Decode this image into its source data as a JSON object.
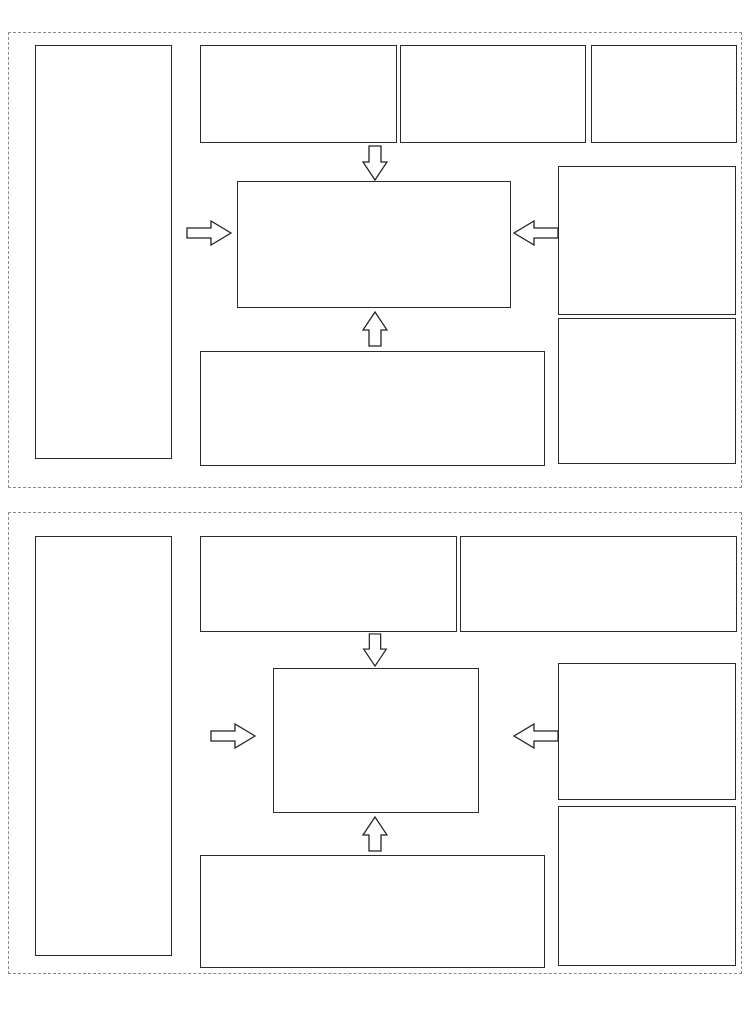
{
  "watermark": "0510-82309771",
  "footer": {
    "note": "注：以上接线均为参考配线，如有改动恕不另行通知，请以仪表随机接线图准。",
    "brand": "CCLair 昌林自动化"
  },
  "colors": {
    "watermark_red": "#ee6a5f",
    "line": "#222222",
    "cap_gray": "#a8a8a8"
  },
  "section1": {
    "title": "◆ 160 × 80mm 、 80 × 160mm 仪表端子接线图",
    "pv_box": {
      "title": "PV控制输入信号接线图",
      "groups": [
        {
          "label": "mV/TC热电偶",
          "symbol": "tc",
          "marks": [
            "+",
            "-"
          ],
          "terminals": [
            "1",
            "2"
          ]
        },
        {
          "label": "V电压",
          "symbol": "stub2",
          "marks": [
            "-",
            "+"
          ],
          "terminals": [
            "1",
            "2"
          ]
        },
        {
          "label": "mA电流",
          "symbol": "stub1brk2",
          "marks": [
            "-",
            "+"
          ],
          "terminals": [
            "1",
            "2",
            "3"
          ]
        },
        {
          "label": "RTD热电阻",
          "symbol": "res3",
          "marks": [],
          "terminals": [
            "1",
            "2",
            "4"
          ]
        },
        {
          "label": "远传压力电阻",
          "symbol": "pot3",
          "marks": [],
          "terminals": [
            "1",
            "2",
            "4"
          ]
        }
      ]
    },
    "sv_box": {
      "title": "SV阀位/外给定输入接线图",
      "groups": [
        {
          "label": "mA电流",
          "symbol": "stub1brk2",
          "marks": [
            "+",
            "-"
          ],
          "terminals": [
            "5",
            "6",
            "7"
          ]
        },
        {
          "label": "V电压",
          "symbol": "stub2",
          "marks": [
            "+",
            "-"
          ],
          "terminals": [
            "5",
            "6"
          ]
        }
      ]
    },
    "alarm_box": {
      "title": "报警输出接线图",
      "alarms": [
        {
          "header": "第一报警",
          "name": "AL1",
          "sw": "ON",
          "terminals": [
            "14",
            "15"
          ]
        },
        {
          "header": "第二报警",
          "name": "AL2",
          "sw": "ON",
          "terminals": [
            "16",
            "17"
          ]
        }
      ]
    },
    "rs485_box": {
      "title": "RS485通讯接口",
      "rows": [
        {
          "label": "T/R (B)",
          "terminal": "11"
        },
        {
          "label": "T/R (A)",
          "terminal": "12"
        }
      ]
    },
    "center_box": {
      "top_row": [
        "1",
        "2",
        "3",
        "4",
        "5",
        "6",
        "7",
        "8",
        "9",
        "10",
        "11",
        "12"
      ],
      "dims": [
        "外形：160×80×100mm",
        "外形：80×160×100mm"
      ],
      "bottom_row": [
        "13",
        "14",
        "15",
        "16",
        "17",
        "18",
        "19",
        "20",
        "21",
        "22",
        "23",
        "24"
      ]
    },
    "power_box": {
      "title": "电源接线图",
      "ac": {
        "terminals": [
          "22",
          "23",
          "24"
        ],
        "ground": "地",
        "label": "AC90~265V",
        "signs": [
          "",
          ""
        ]
      },
      "dc": {
        "terminals": [
          "23",
          "24"
        ],
        "label": "DC24V",
        "signs": [
          "+",
          "-"
        ]
      }
    },
    "output_box": {
      "title": "输出接线图",
      "groups": [
        {
          "label": "调节输出",
          "terminals": [
            "9",
            "10"
          ],
          "sig": "mA/V",
          "signs": [
            "-",
            "+"
          ]
        },
        {
          "label": "变送输出",
          "terminals": [
            "11",
            "12"
          ],
          "sig": "mA/V",
          "signs": [
            "-",
            "+"
          ]
        },
        {
          "label": "馈电输出",
          "terminals": [
            "1",
            "13"
          ],
          "sig": "DC24V",
          "signs": [
            "-",
            "+"
          ]
        }
      ]
    },
    "valve_box": {
      "title": "阀位控制输出接线图",
      "relay": {
        "caption": "继电器控制输出接线图",
        "groups": [
          {
            "label": "正转",
            "sw": "ON",
            "terminals": [
              "20",
              "21"
            ]
          },
          {
            "label": "反转",
            "sw": "ON",
            "terminals": [
              "18",
              "19"
            ]
          }
        ]
      },
      "scr": {
        "caption": "双向可控硅控制输出",
        "rows": [
          {
            "label": "反转输出",
            "arrow": "left",
            "terminal": "19"
          },
          {
            "label": "相线",
            "arrow": "right",
            "terminal": "20"
          },
          {
            "label": "正转输出",
            "arrow": "left",
            "terminal": "21"
          }
        ]
      }
    }
  },
  "section2": {
    "title": "◆ 96 × 96mm 仪表端子接线图",
    "pv_box": {
      "title": "PV控制输入信号接线图",
      "groups": [
        {
          "label": "mV/TC热电偶",
          "symbol": "tc",
          "marks": [
            "+",
            "-"
          ],
          "terminals": [
            "1",
            "2"
          ]
        },
        {
          "label": "V电压",
          "symbol": "stub2",
          "marks": [
            "-",
            "+"
          ],
          "terminals": [
            "1",
            "4"
          ]
        },
        {
          "label": "mA电流",
          "symbol": "stub2",
          "marks": [
            "-",
            "+"
          ],
          "terminals": [
            "1",
            "2"
          ]
        },
        {
          "label": "RTD热电阻",
          "symbol": "res3",
          "marks": [],
          "terminals": [
            "1",
            "2",
            "3"
          ]
        },
        {
          "label": "远传压力电阻",
          "symbol": "pot3",
          "marks": [],
          "terminals": [
            "1",
            "2",
            "3"
          ]
        }
      ]
    },
    "sv_box": {
      "title": "SV阀位/外给定输入接线图",
      "groups": [
        {
          "label": "mA电流",
          "symbol": "stub2",
          "marks": [
            "+",
            "-"
          ],
          "terminals": [
            "5",
            "6"
          ]
        },
        {
          "label": "V电压",
          "symbol": "stub2",
          "marks": [
            "+",
            "-"
          ],
          "terminals": [
            "5",
            "8"
          ]
        }
      ]
    },
    "alarm_box": {
      "title": "报警输出接线图",
      "alarms": [
        {
          "header": "第一报警",
          "name": "AL1",
          "sw": "ON",
          "terminals": [
            "17",
            "18"
          ]
        },
        {
          "header": "第二报警",
          "name": "AL2",
          "sw": "ON",
          "terminals": [
            "19",
            "20"
          ]
        }
      ]
    },
    "center_box": {
      "left_col": [
        "1",
        "2",
        "3",
        "4",
        "5",
        "6",
        "7",
        "8"
      ],
      "mid_col": [
        "17",
        "18",
        "19",
        "20",
        "21",
        "22",
        "23",
        "24"
      ],
      "right_col": [
        "9",
        "10",
        "11",
        "12",
        "13",
        "14",
        "15",
        "16"
      ],
      "dim": "外形：96×96×110mm"
    },
    "power_box": {
      "title": "电源接线图",
      "ac": {
        "terminals": [
          "15",
          "16"
        ],
        "label": "AC90~265V",
        "signs": [
          "",
          ""
        ]
      },
      "dc": {
        "terminals": [
          "23",
          "24"
        ],
        "label": "DC24V",
        "signs": [
          "+",
          "-"
        ]
      }
    },
    "output_box": {
      "title": "输出接线图",
      "groups": [
        {
          "label": "调节输出",
          "terminals": [
            "9",
            "10"
          ],
          "sig": "mA/V",
          "signs": [
            "-",
            "+"
          ]
        },
        {
          "label": "变送输出",
          "terminals": [
            "11",
            "12"
          ],
          "sig": "mA/V",
          "signs": [
            "-",
            "+"
          ]
        },
        {
          "label": "馈电输出",
          "terminals": [
            "1",
            "13"
          ],
          "sig": "DC24V",
          "signs": [
            "-",
            "+"
          ]
        }
      ]
    },
    "valve_box": {
      "title": "阀位控制输出接线图",
      "relay": {
        "caption": "继电器控制输出接线图",
        "groups": [
          {
            "label": "正转",
            "sw": "ON",
            "terminals": [
              "9",
              "10"
            ]
          },
          {
            "label": "反转",
            "sw": "ON",
            "terminals": [
              "11",
              "12"
            ]
          }
        ]
      },
      "scr": {
        "caption": "双向可控硅控制输出",
        "rows": [
          {
            "label": "正转输出",
            "arrow": "left",
            "terminal": "9"
          },
          {
            "label": "相线",
            "arrow": "right",
            "terminal": "10"
          },
          {
            "label": "反转输出",
            "arrow": "left",
            "terminal": "11"
          }
        ]
      }
    }
  }
}
